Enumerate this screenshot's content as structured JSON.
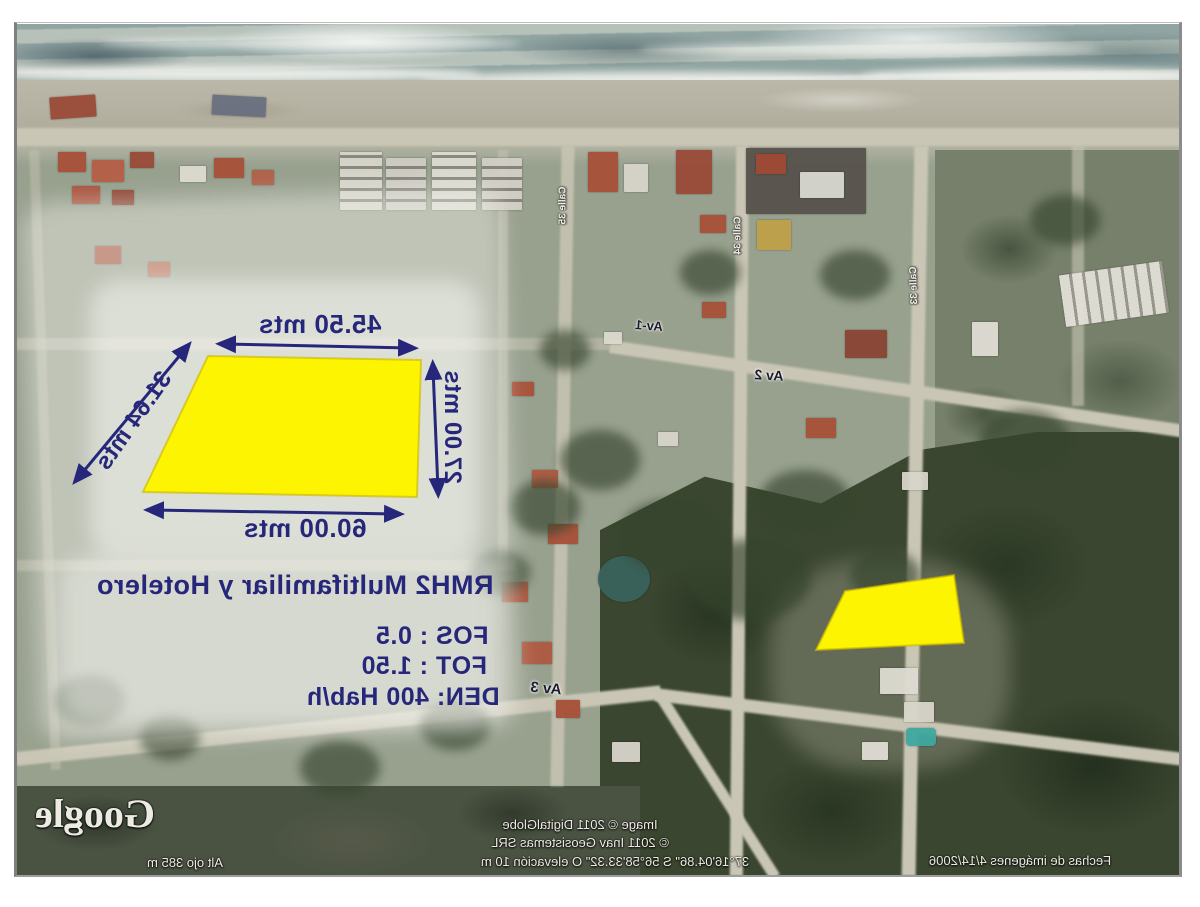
{
  "annotations": {
    "dim_top": "45.50 mts",
    "dim_left": "31.64 mts",
    "dim_right": "27.00 mts",
    "dim_bottom": "60.00 mts",
    "zoning_title": "RMH2 Multifamiliar y Hotelero",
    "fos": "FOS : 0.5",
    "fot": "FOT : 1.50",
    "den": "DEN: 400 Hab/h",
    "annotation_color": "#26267a",
    "parcel_color": "#fcf400"
  },
  "streets": {
    "av1": "Av-1",
    "av2": "Av 2",
    "av3": "Av 3",
    "cross1": "Calle 35",
    "cross2": "Calle 34",
    "cross3": "Calle 33"
  },
  "statusbar": {
    "logo": "Google",
    "credit1": "Image © 2011 DigitalGlobe",
    "credit2": "© 2011 Inav Geosistemas SRL",
    "coords": "37°16'04.86\" S   56°58'33.32\" O   elevación   10 m",
    "eye_alt": "Alt ojo   385 m",
    "imagery_date": "Fechas de imágenes   4/14/2006"
  }
}
